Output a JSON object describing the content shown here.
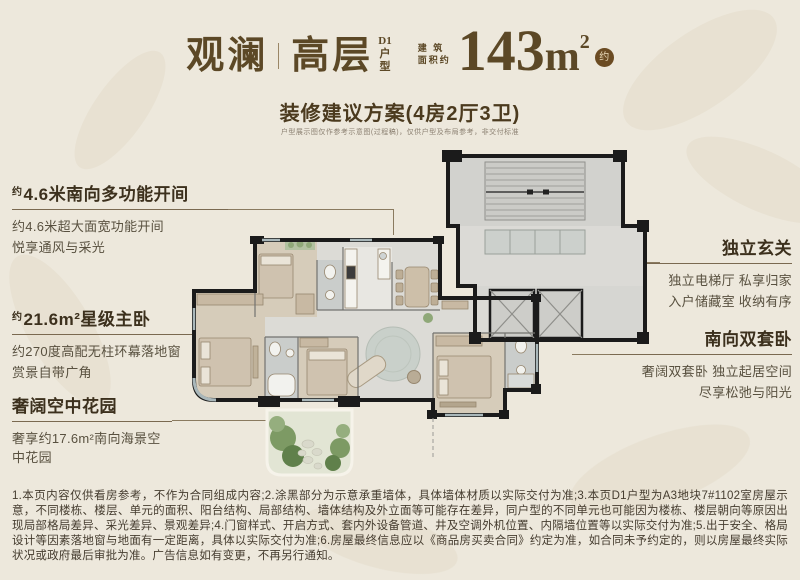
{
  "colors": {
    "background": "#EDE8DC",
    "accent_brown": "#5C4826",
    "wall_black": "#1B1B1B",
    "garden_green": "#7D9A64",
    "bedroom_tan": "#D6CCBA"
  },
  "header": {
    "project_name": "观澜",
    "product_type": "高层",
    "unit_lines": [
      "D1",
      "户",
      "型"
    ],
    "area_prefix_lines": [
      "建 筑",
      "面积约"
    ],
    "area_number": "143",
    "area_unit": "m",
    "area_sup": "2",
    "area_badge": "约"
  },
  "subtitle": "装修建议方案(4房2厅3卫)",
  "caption": "户型展示图仅作参考示意图(过程稿)，仅供户型及布局参考，非交付标准",
  "annotations": {
    "left": [
      {
        "prefix": "约",
        "title": "4.6米南向多功能开间",
        "lines": [
          "约4.6米超大面宽功能开间",
          "悦享通风与采光"
        ]
      },
      {
        "prefix": "约",
        "title": "21.6m²星级主卧",
        "lines": [
          "约270度高配无柱环幕落地窗",
          "赏景自带广角"
        ]
      },
      {
        "prefix": "",
        "title": "奢阔空中花园",
        "lines": [
          "奢享约17.6m²南向海景空中花园",
          ""
        ]
      }
    ],
    "right": [
      {
        "title": "独立玄关",
        "lines": [
          "独立电梯厅 私享归家",
          "入户储藏室 收纳有序"
        ]
      },
      {
        "title": "南向双套卧",
        "lines": [
          "奢阔双套卧 独立起居空间",
          "尽享松弛与阳光"
        ]
      }
    ]
  },
  "disclaimer": "1.本页内容仅供看房参考，不作为合同组成内容;2.涂黑部分为示意承重墙体，具体墙体材质以实际交付为准;3.本页D1户型为A3地块7#1102室房屋示意，不同楼栋、楼层、单元的面积、阳台结构、局部结构、墙体结构及外立面等可能存在差异，同户型的不同单元也可能因为楼栋、楼层朝向等原因出现局部格局差异、采光差异、景观差异;4.门窗样式、开启方式、套内外设备管道、井及空调外机位置、内隔墙位置等以实际交付为准;5.出于安全、格局设计等因素落地窗与地面有一定距离，具体以实际交付为准;6.房屋最终信息应以《商品房买卖合同》约定为准，如合同未予约定的，则以房屋最终实际状况或政府最后审批为准。广告信息如有变更，不再另行通知。"
}
